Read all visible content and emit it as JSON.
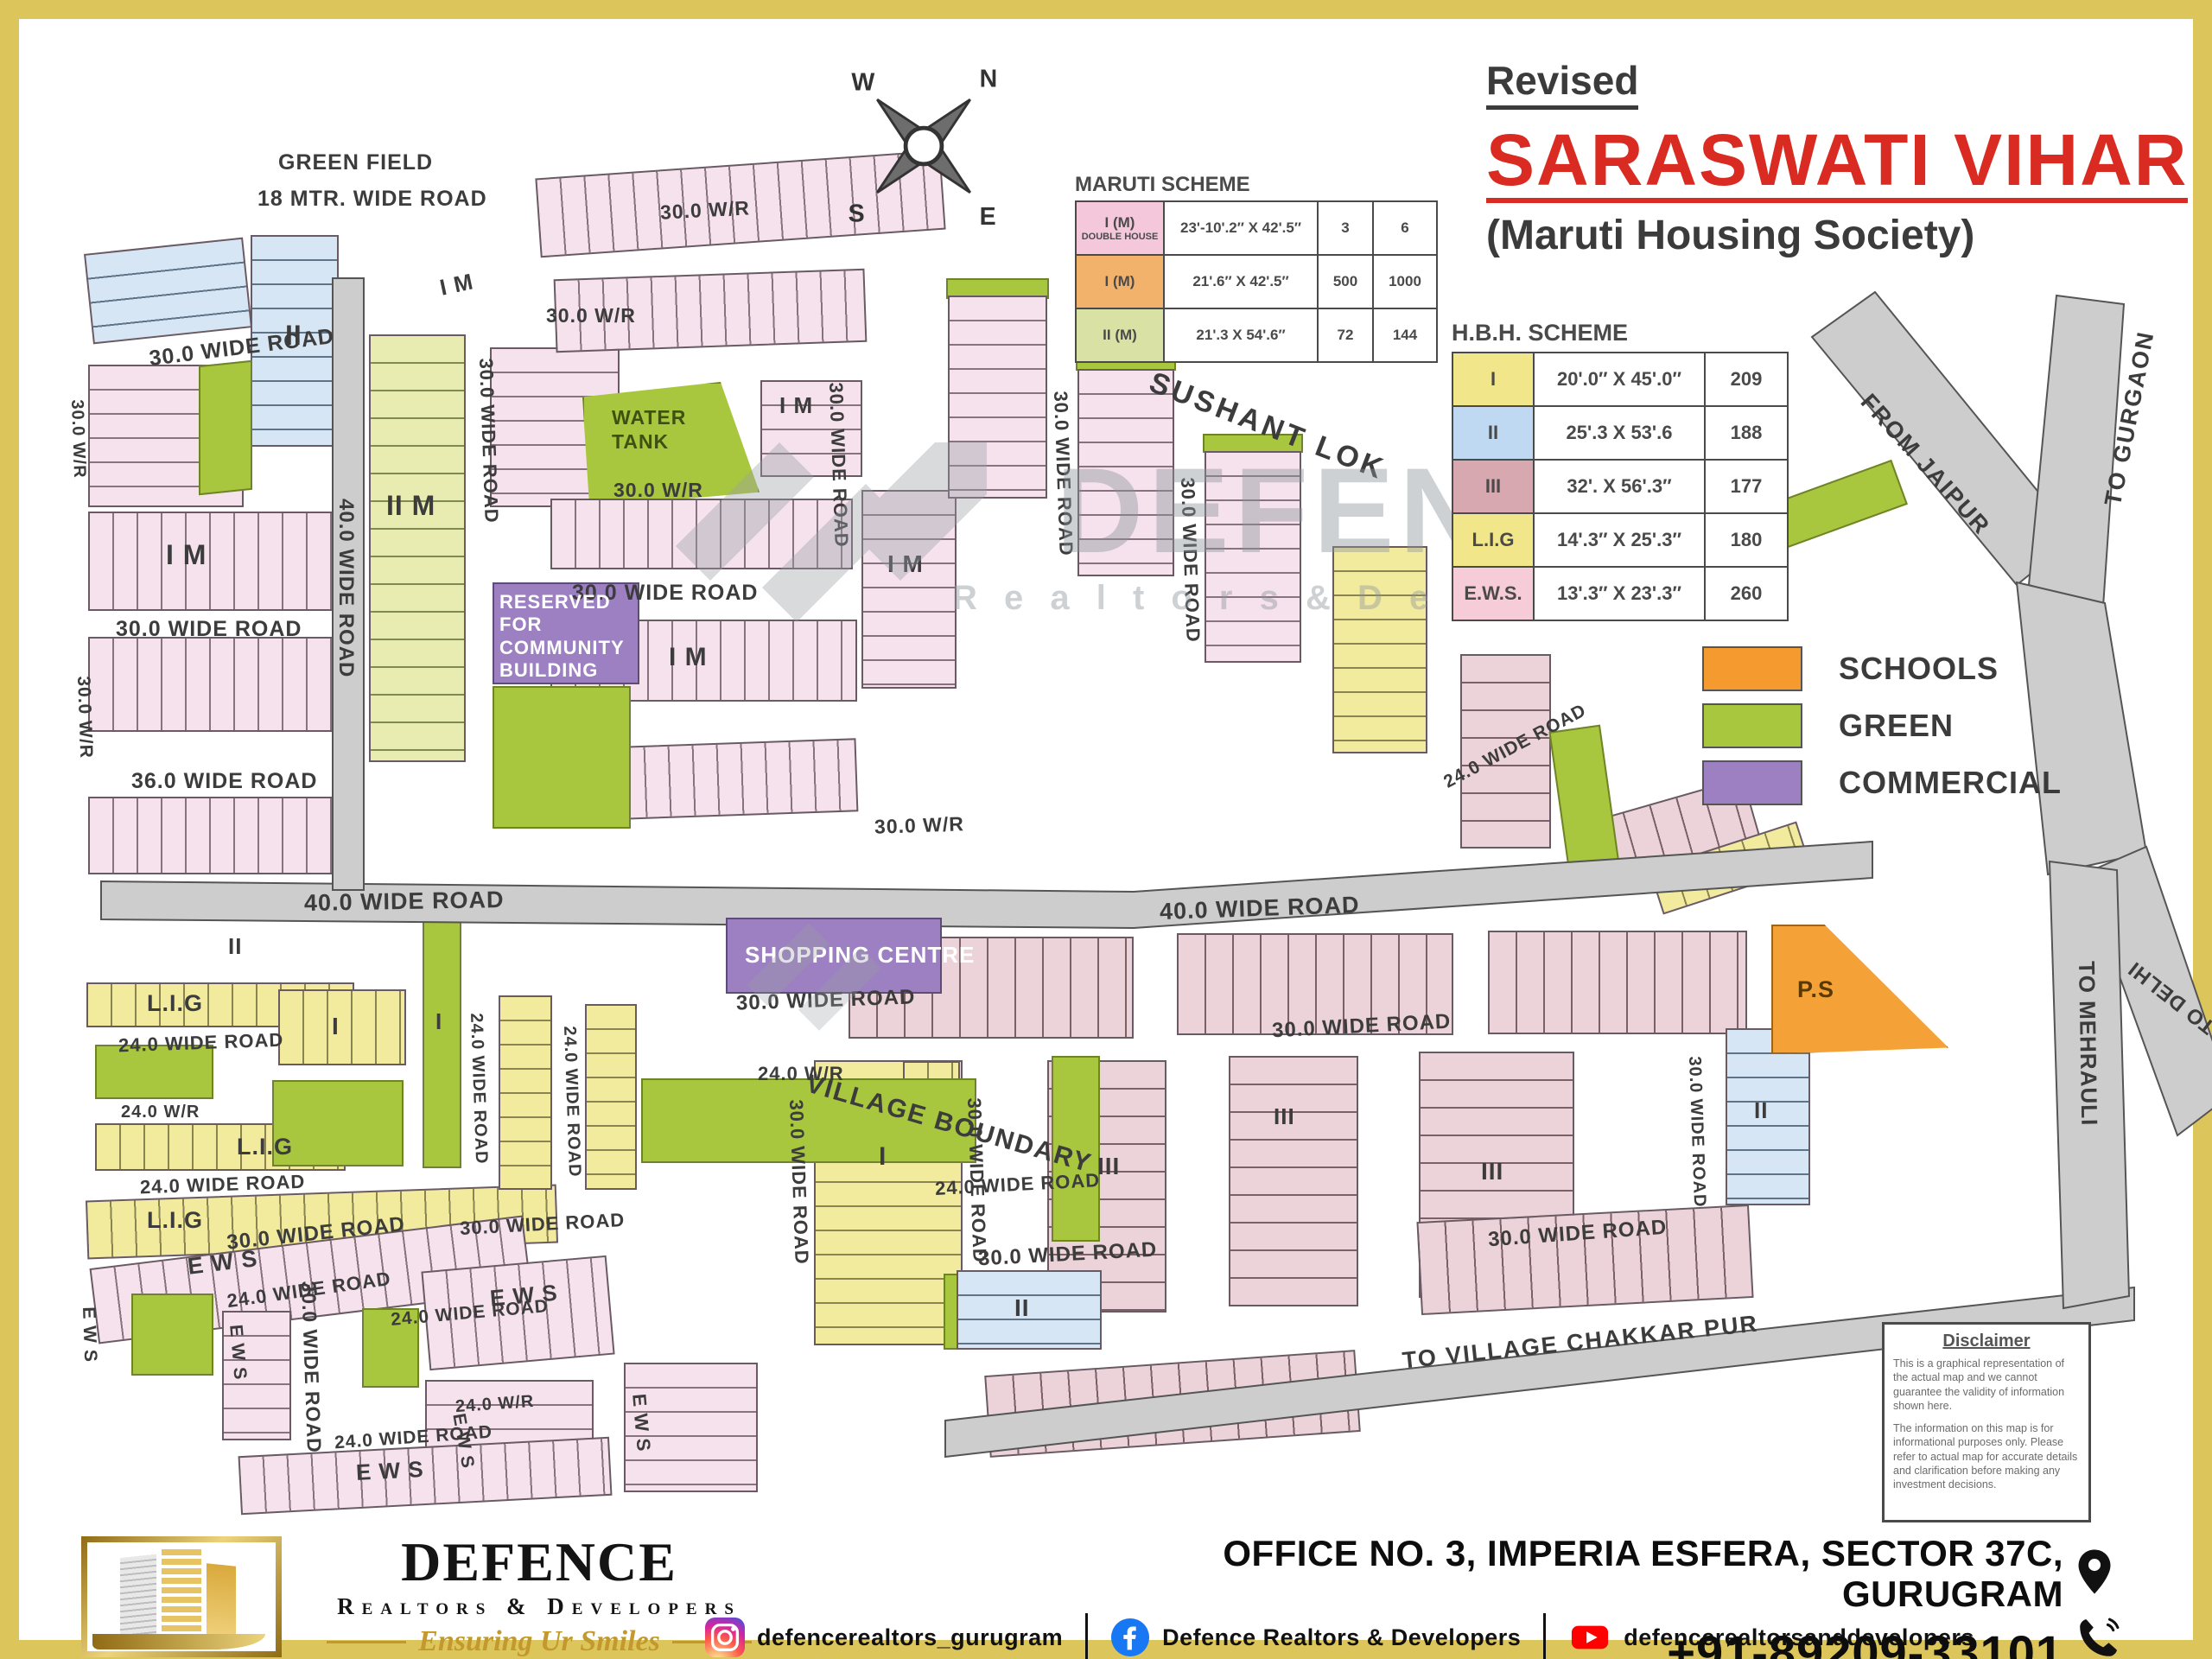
{
  "frame": {
    "color": "#dcc65b"
  },
  "header": {
    "revised": "Revised",
    "title": "SARASWATI VIHAR",
    "subtitle": "(Maruti Housing Society)",
    "title_color": "#d92b21",
    "text_color": "#3b3b3b"
  },
  "compass": {
    "n": "N",
    "e": "E",
    "s": "S",
    "w": "W"
  },
  "maruti_scheme": {
    "title": "MARUTI SCHEME",
    "rows": [
      {
        "label": "I (M)",
        "sublabel": "DOUBLE HOUSE",
        "size": "23'-10'.2″ X 42'.5″",
        "plots": "3",
        "doubles": "6",
        "color": "#f4c7da"
      },
      {
        "label": "I (M)",
        "sublabel": "",
        "size": "21'.6″ X 42'.5″",
        "plots": "500",
        "doubles": "1000",
        "color": "#f2b26c"
      },
      {
        "label": "II (M)",
        "sublabel": "",
        "size": "21'.3 X 54'.6″",
        "plots": "72",
        "doubles": "144",
        "color": "#d9e2a4"
      }
    ]
  },
  "hbh_scheme": {
    "title": "H.B.H. SCHEME",
    "rows": [
      {
        "label": "I",
        "size": "20'.0″ X 45'.0″",
        "count": "209",
        "color": "#f2e68a"
      },
      {
        "label": "II",
        "size": "25'.3 X 53'.6",
        "count": "188",
        "color": "#bed9f1"
      },
      {
        "label": "III",
        "size": "32'. X 56'.3″",
        "count": "177",
        "color": "#d7a8af"
      },
      {
        "label": "L.I.G",
        "size": "14'.3″ X 25'.3″",
        "count": "180",
        "color": "#f2e68a"
      },
      {
        "label": "E.W.S.",
        "size": "13'.3″ X 23'.3″",
        "count": "260",
        "color": "#f6ccd8"
      }
    ]
  },
  "legend": {
    "items": [
      {
        "label": "SCHOOLS",
        "color": "#f59a2f"
      },
      {
        "label": "GREEN",
        "color": "#a9c63f"
      },
      {
        "label": "COMMERCIAL",
        "color": "#9c80c1"
      }
    ]
  },
  "map": {
    "labels": {
      "green_field": "GREEN FIELD",
      "mtr18": "18 MTR. WIDE ROAD",
      "sushant": "SUSHANT LOK",
      "water_tank": "WATER TANK",
      "community": "RESERVED FOR COMMUNITY BUILDING",
      "shopping": "SHOPPING CENTRE",
      "village_boundary": "VILLAGE BOUNDARY",
      "ps": "P.S",
      "road40": "40.0 WIDE ROAD",
      "road30": "30.0 WIDE ROAD",
      "road30wr": "30.0 W/R",
      "road24": "24.0 WIDE ROAD",
      "road24wr": "24.0 W/R",
      "road36": "36.0 WIDE ROAD",
      "lig": "L.I.G",
      "ews": "E W S",
      "im": "I M",
      "iim": "II M",
      "blk_i": "I",
      "blk_ii": "II",
      "blk_iii": "III",
      "from_jaipur": "FROM JAIPUR",
      "to_gurgaon": "TO GURGAON",
      "to_delhi": "TO DELHI",
      "to_mehrauli": "TO MEHRAULI",
      "to_chakkar": "TO VILLAGE CHAKKAR PUR"
    }
  },
  "watermark": {
    "name": "DEFENCE",
    "sub": "R e a l t o r s   &   D e v e l o p e r s"
  },
  "disclaimer": {
    "title": "Disclaimer",
    "p1": "This is a graphical representation of the actual map and we cannot guarantee the validity of information shown here.",
    "p2": "The information on this map is for informational purposes only. Please refer to actual map for accurate details and clarification before making any investment decisions."
  },
  "footer": {
    "brand": "DEFENCE",
    "brand_sub": "Realtors & Developers",
    "tagline": "Ensuring Ur Smiles",
    "socials": [
      {
        "network": "instagram",
        "handle": "defencerealtors_gurugram"
      },
      {
        "network": "facebook",
        "handle": "Defence Realtors & Developers"
      },
      {
        "network": "youtube",
        "handle": "defencerealtorsanddevelopers"
      }
    ],
    "address_line1": "OFFICE NO. 3, IMPERIA ESFERA, SECTOR 37C,",
    "address_line2": "GURUGRAM",
    "phone": "+91-89209-33101"
  }
}
